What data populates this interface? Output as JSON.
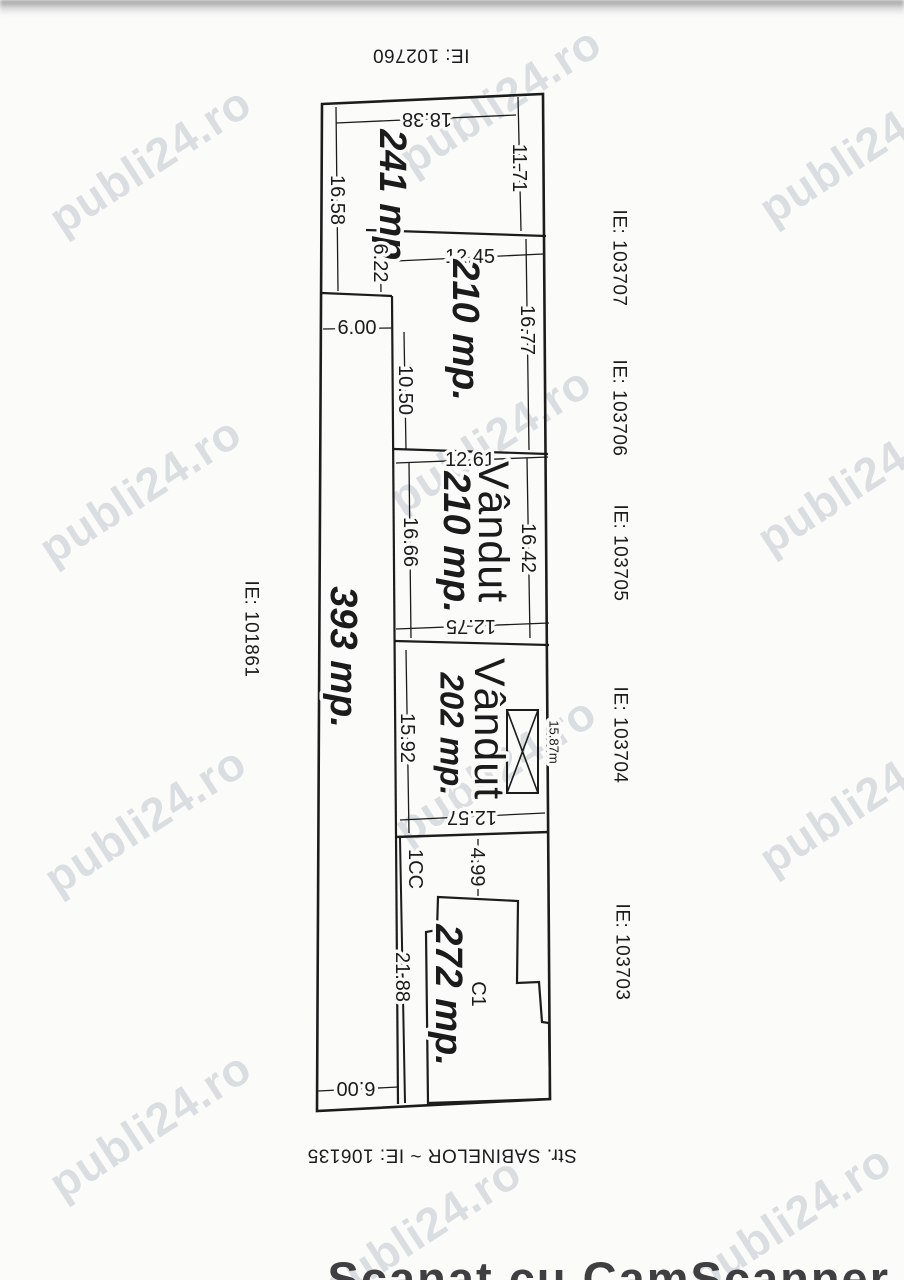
{
  "page": {
    "watermark_text": "publi24.ro",
    "scanner_footer": "Scanat cu CamScanner"
  },
  "labels": {
    "ie_top": "IE: 102760",
    "ie_left": "IE: 101861",
    "ie_r1": "IE: 103707",
    "ie_r2": "IE: 103706",
    "ie_r3": "IE: 103705",
    "ie_r4": "IE: 103704",
    "ie_r5": "IE: 103703",
    "street": "Str. SABINELOR ~ IE: 106135"
  },
  "areas": {
    "a241": "241 mp.",
    "a210a": "210 mp.",
    "a210b": "210 mp.",
    "a202": "202 mp.",
    "a272": "272 mp.",
    "a393": "393 mp."
  },
  "sold": "Vândut",
  "codes": {
    "cc": "1CC",
    "c1": "C1"
  },
  "dims": {
    "d1838": "18.38",
    "d1171": "11.71",
    "d1658": "16.58",
    "d622": "6.22",
    "d600top": "6.00",
    "d1245": "12.45",
    "d1677": "16.77",
    "d1050": "10.50",
    "d1261": "12.61",
    "d1642": "16.42",
    "d1666": "16.66",
    "d1275": "12.75",
    "d1592": "15.92",
    "d1587": "15.87m",
    "d1257": "12.57",
    "d499": "4.99",
    "d2188": "21.88",
    "d600bot": "6.00"
  }
}
